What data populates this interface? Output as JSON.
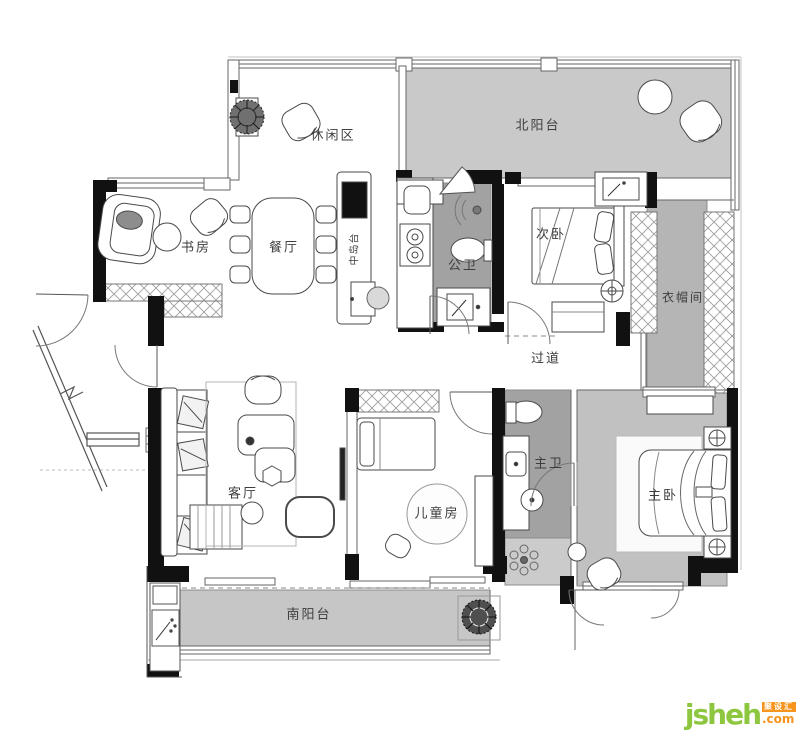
{
  "plan": {
    "rooms": [
      {
        "id": "leisure",
        "label": "休闲区"
      },
      {
        "id": "north_balcony",
        "label": "北阳台"
      },
      {
        "id": "study",
        "label": "书房"
      },
      {
        "id": "dining",
        "label": "餐厅"
      },
      {
        "id": "island",
        "label": "中岛台"
      },
      {
        "id": "public_bath",
        "label": "公卫"
      },
      {
        "id": "second_bedroom",
        "label": "次卧"
      },
      {
        "id": "cloakroom",
        "label": "衣帽间"
      },
      {
        "id": "corridor",
        "label": "过道"
      },
      {
        "id": "living",
        "label": "客厅"
      },
      {
        "id": "kids_room",
        "label": "儿童房"
      },
      {
        "id": "master_bath",
        "label": "主卫"
      },
      {
        "id": "master_bedroom",
        "label": "主卧"
      },
      {
        "id": "south_balcony",
        "label": "南阳台"
      }
    ],
    "colors": {
      "wall": "#111111",
      "balcony_floor": "#c9c9c9",
      "bath_floor": "#a2a2a2",
      "cloak_floor": "#b5b5b5",
      "master_floor": "#c1c1c1",
      "shower_floor": "#cbcbcb",
      "south_balcony_floor": "#c6c6c6"
    }
  },
  "watermark": {
    "brand": "jsheh",
    "suffix": ".com",
    "cn_name": "聚设汇",
    "green": "#8dc63f",
    "orange": "#f7941e"
  }
}
